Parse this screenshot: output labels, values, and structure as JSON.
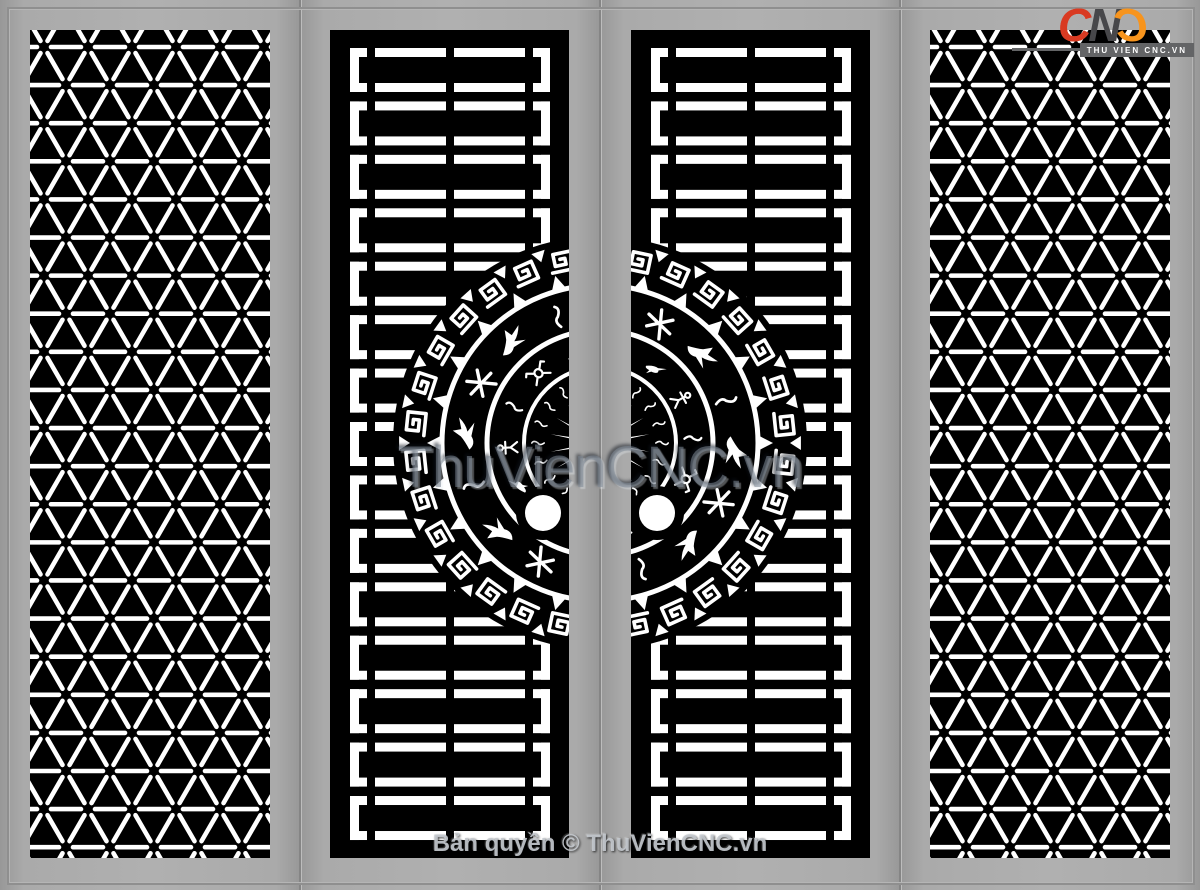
{
  "branding": {
    "c1": "C",
    "c2": "N",
    "c3": "C",
    "logo_text": "CNC",
    "logo_tagline": "THU VIEN CNC.VN"
  },
  "watermark": {
    "text": "ThuVienCNC.vn"
  },
  "footer": {
    "copyright": "Bản quyền © ThuVienCNC.vn"
  },
  "colors": {
    "background": "#a6a6a6",
    "panel": "#000000",
    "cut": "#ffffff",
    "seam": "#858585",
    "logo_red": "#d93a22",
    "logo_dark": "#47474a",
    "logo_orange": "#f7941d",
    "banner": "#636466",
    "watermark_gray": "#808a98"
  },
  "panels": [
    {
      "name": "panel-lattice-left",
      "type": "lattice"
    },
    {
      "name": "panel-ladder-left",
      "type": "ladder-drum",
      "drum_side": "right"
    },
    {
      "name": "panel-ladder-right",
      "type": "ladder-drum",
      "drum_side": "left"
    },
    {
      "name": "panel-lattice-right",
      "type": "lattice"
    }
  ],
  "geometry": {
    "stage": {
      "w": 1200,
      "h": 890
    },
    "leaves": [
      0,
      300,
      600,
      900
    ],
    "panel_rects": {
      "p1": {
        "x": 30,
        "y": 30,
        "w": 240,
        "h": 828
      },
      "p2": {
        "x": 330,
        "y": 30,
        "w": 239,
        "h": 828
      },
      "p3": {
        "x": 631,
        "y": 30,
        "w": 239,
        "h": 828
      },
      "p4": {
        "x": 930,
        "y": 30,
        "w": 240,
        "h": 828
      }
    },
    "lattice": {
      "a": 44,
      "stroke": 4.6,
      "trim": 7,
      "x0": 14,
      "y0": 17
    },
    "ladder": {
      "frame_x": 20,
      "frame_w": 200,
      "frame_h": 44,
      "bar": 9,
      "pitch": 53.43,
      "count": 15,
      "y0": 18,
      "segs": [
        [
          0,
          17
        ],
        [
          25,
          96
        ],
        [
          104,
          175
        ],
        [
          183,
          200
        ]
      ]
    },
    "drum": {
      "cx": 600,
      "cy": 443,
      "mask_r": 207,
      "arcs": [
        [
          158,
          5
        ],
        [
          113,
          5
        ],
        [
          76,
          4
        ]
      ],
      "meander": {
        "r": 185,
        "n": 30
      },
      "tri_in": {
        "base": 201,
        "apex": 190,
        "n": 30
      },
      "tri_out": {
        "base": 160,
        "apex": 173,
        "n": 24
      },
      "bandB": {
        "r": 133,
        "n": 16
      },
      "bandA": {
        "r": 93,
        "n": 14
      },
      "squiggle": {
        "r": 62,
        "n": 20
      },
      "star": {
        "base": 16,
        "apex": 50,
        "n": 18
      },
      "handle": {
        "dx": 57,
        "dy": 70,
        "r": 18,
        "ring": 27
      }
    }
  }
}
